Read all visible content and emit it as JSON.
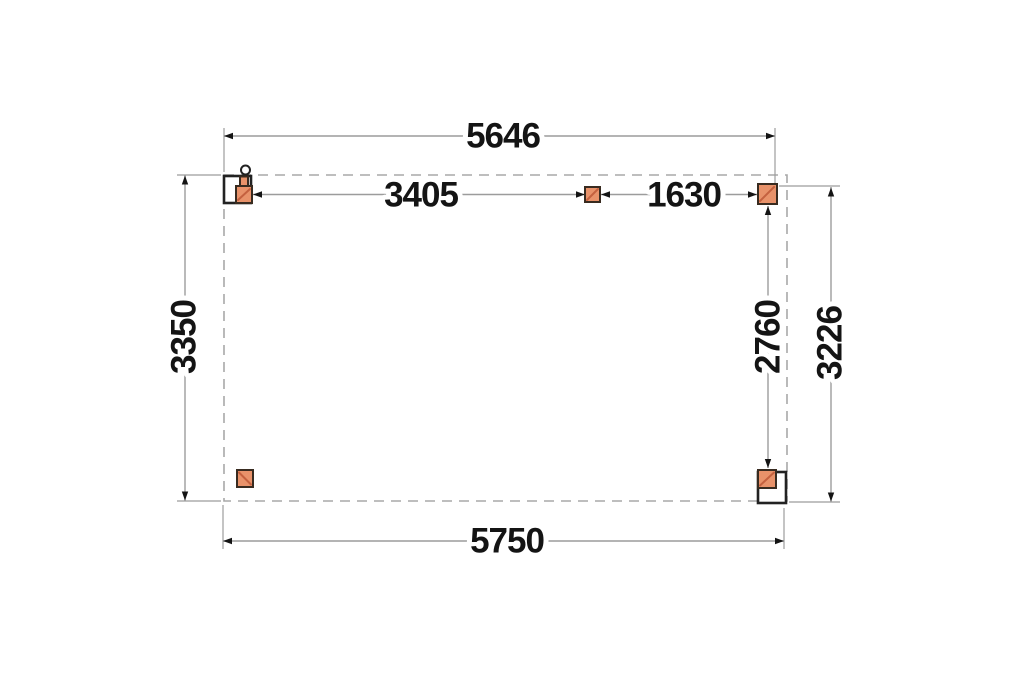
{
  "dimensions": {
    "top_width": "5646",
    "top_span_left": "3405",
    "top_span_right": "1630",
    "left_height": "3350",
    "right_post_span": "2760",
    "right_height": "3226",
    "bottom_width": "5750"
  },
  "colors": {
    "background": "#ffffff",
    "dim_line": "#9c9c9c",
    "dash_line": "#a8a8a8",
    "arrow": "#141414",
    "text": "#141414",
    "post_fill": "#e8926a",
    "post_hatch": "#c4613f",
    "post_outline": "#382b20",
    "base_outline": "#222222"
  }
}
